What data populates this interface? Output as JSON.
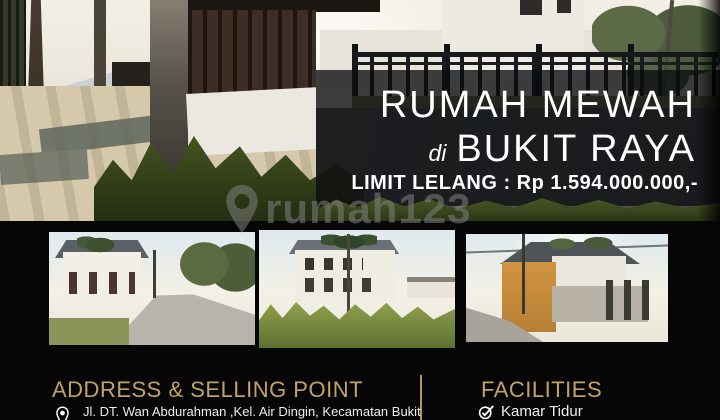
{
  "listing": {
    "title_line1": "RUMAH MEWAH",
    "title_connector": "di",
    "title_line2": "BUKIT RAYA",
    "price_line": "LIMIT LELANG : Rp 1.594.000.000,-"
  },
  "watermark": {
    "brand": "rumah123"
  },
  "address_section": {
    "title": "ADDRESS & SELLING POINT",
    "address_line": "Jl. DT. Wan Abdurahman ,Kel. Air Dingin, Kecamatan Bukit"
  },
  "facilities_section": {
    "title": "FACILITIES",
    "items": [
      {
        "label": "Kamar Tidur"
      }
    ]
  },
  "icons": {
    "watermark_logo": "map-pin-icon",
    "address": "location-pin-icon",
    "facility": "check-icon"
  },
  "colors": {
    "accent_gold": "#c2a16b",
    "headline_white": "#ffffff",
    "background_black": "#060606",
    "watermark_gray": "#7d7d7d",
    "overlay": "rgba(10,12,15,0.78)"
  }
}
